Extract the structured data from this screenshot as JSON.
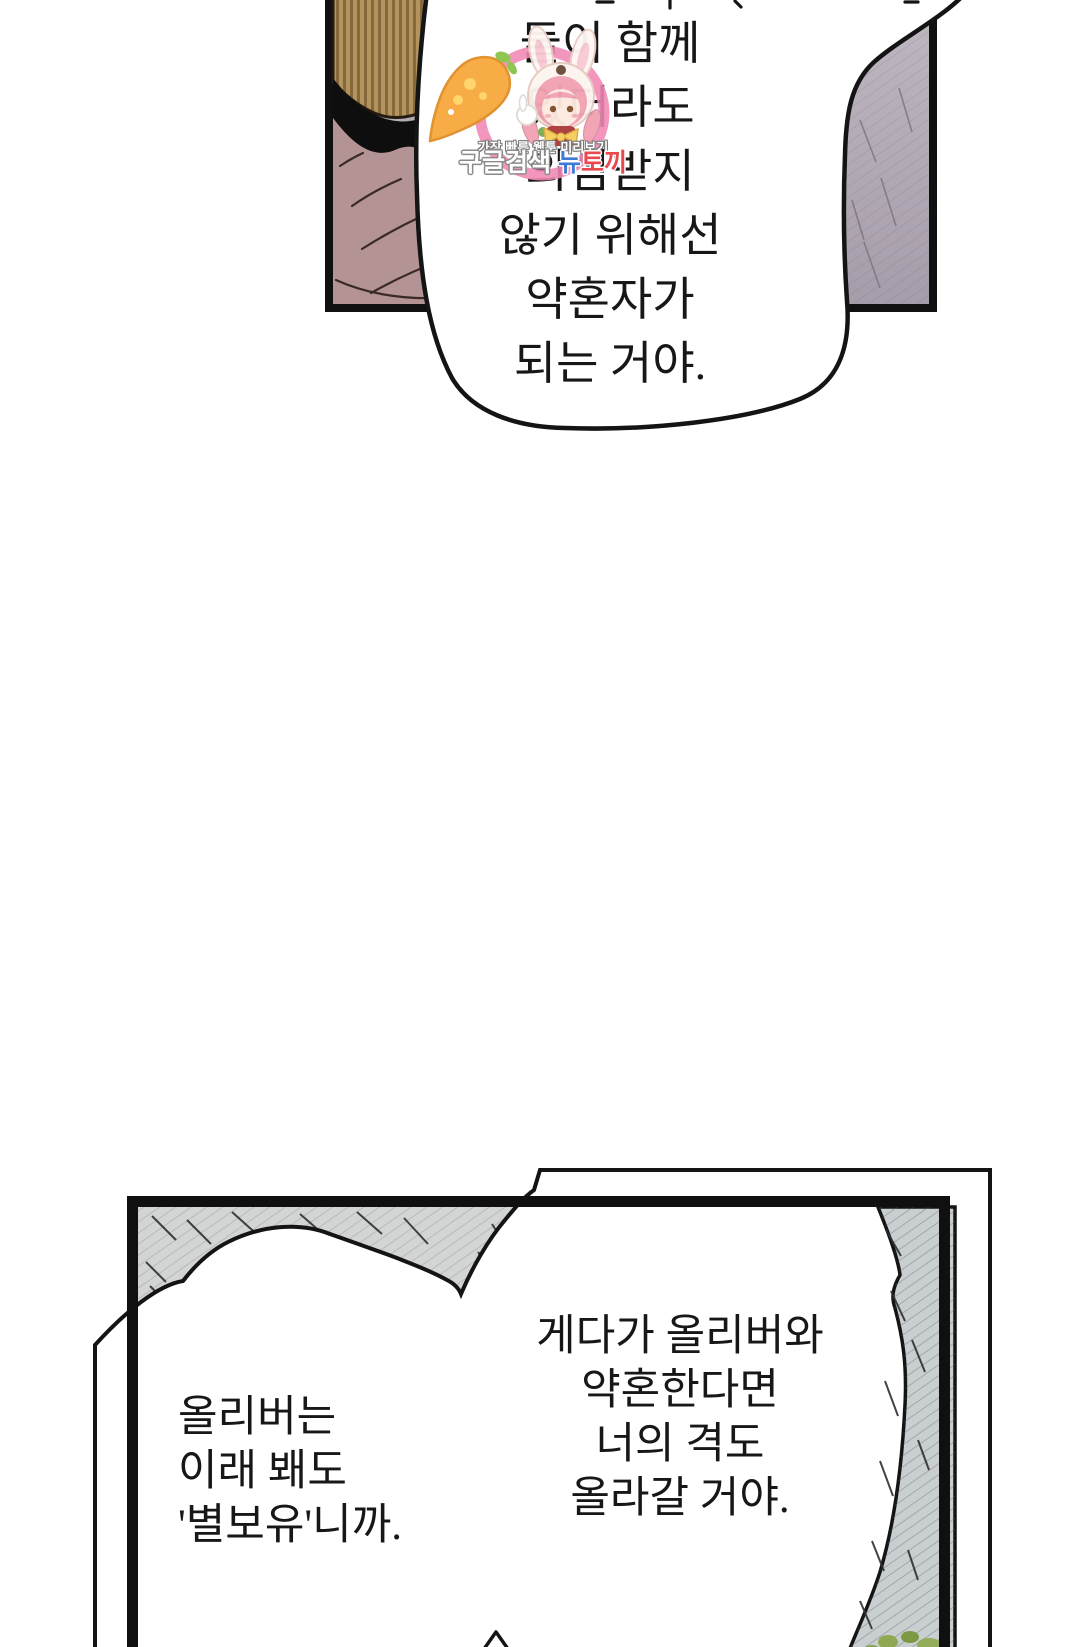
{
  "page": {
    "type": "webtoon-comic-page",
    "background_color": "#ffffff",
    "panel_border_color": "#101010"
  },
  "panels": {
    "top": {
      "description": "partial panel, figure with striped tan hair and mauve clothing, gray-lavender background",
      "colors": {
        "background": "#b6aeb7",
        "hair": "#b2945c",
        "hair_stripe": "#86683c",
        "collar": "#0e0e0e",
        "clothing": "#b39394"
      },
      "speech_bubble": {
        "lines": [
          "둘이 함께",
          "있더라도",
          "의심받지",
          "않기 위해선",
          "약혼자가",
          "되는 거야."
        ]
      }
    },
    "bottom": {
      "description": "cave-like panel, gray hatched ceiling and rocky right column with green moss, two merged white speech bubbles",
      "colors": {
        "background": "#d3d5d5",
        "rock": "#c9ced0",
        "moss_green": "#8fa952"
      },
      "left_bubble": {
        "lines": [
          "올리버는",
          "이래 봬도",
          "'별보유'니까."
        ]
      },
      "right_bubble": {
        "lines": [
          "게다가 올리버와",
          "약혼한다면",
          "너의 격도",
          "올라갈 거야."
        ]
      }
    }
  },
  "watermark": {
    "mascot": "bunny-hood-girl-with-carrot-illustration",
    "ring_color": "#f189b5",
    "tagline": "가장 빠른 웹툰 미리보기",
    "brand_part1": "구글검색",
    "brand_part2": "뉴",
    "brand_part3": "토끼",
    "brand_colors": {
      "part1": "#ffffff",
      "part2": "#3d7ad1",
      "part3": "#e8484e"
    }
  }
}
